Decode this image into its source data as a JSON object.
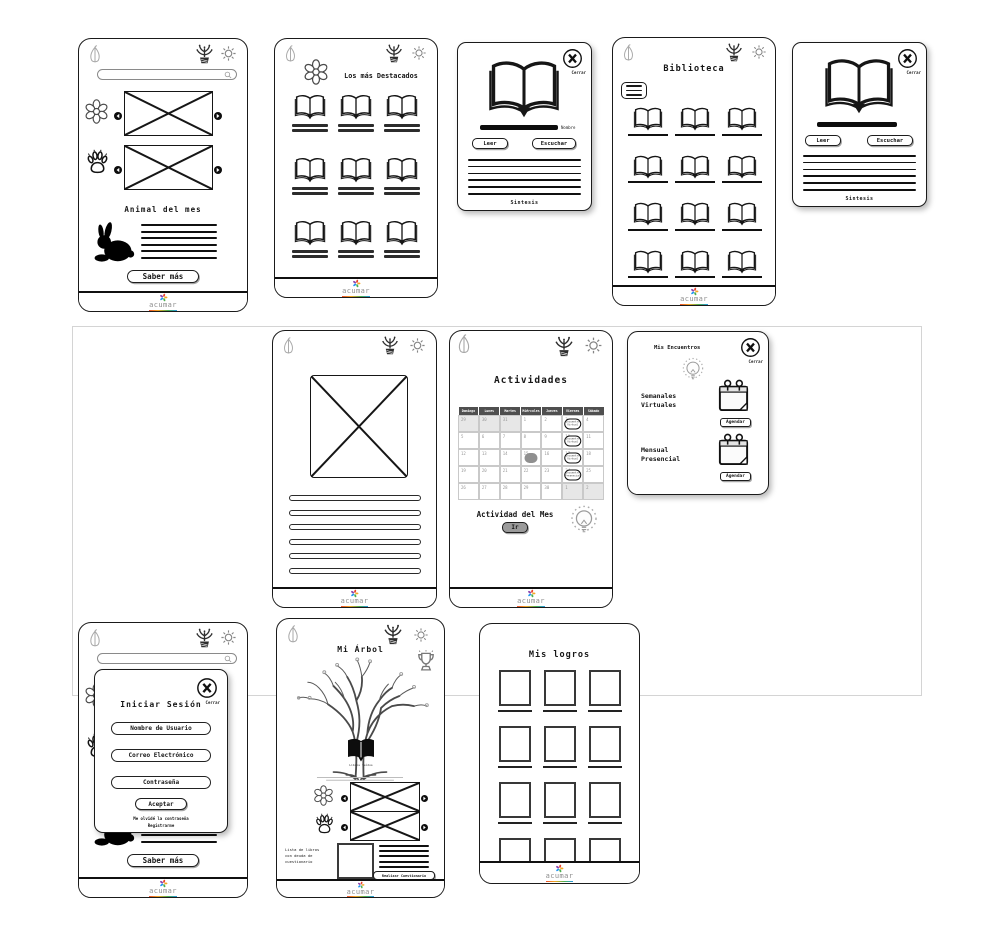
{
  "brand": {
    "name": "acumar"
  },
  "home": {
    "animal_title": "Animal del mes",
    "saber_mas": "Saber más"
  },
  "destacados": {
    "title": "Los más Destacados"
  },
  "book_detail": {
    "cerrar": "Cerrar",
    "nombre": "Nombre",
    "leer": "Leer",
    "escuchar": "Escuchar",
    "sintesis": "Sintesis"
  },
  "biblioteca": {
    "title": "Biblioteca"
  },
  "actividades": {
    "title": "Actividades",
    "actividad_mes": "Actividad del Mes",
    "ir": "Ir",
    "calendar": {
      "day_headers": [
        "Domingo",
        "Lunes",
        "Martes",
        "Miércoles",
        "Jueves",
        "Viernes",
        "Sábado"
      ],
      "weeks": [
        [
          "29",
          "30",
          "31",
          "1",
          "2",
          "3",
          "4"
        ],
        [
          "5",
          "6",
          "7",
          "8",
          "9",
          "10",
          "11"
        ],
        [
          "12",
          "13",
          "14",
          "15",
          "16",
          "17",
          "18"
        ],
        [
          "19",
          "20",
          "21",
          "22",
          "23",
          "24",
          "25"
        ],
        [
          "26",
          "27",
          "28",
          "29",
          "30",
          "1",
          "2"
        ]
      ],
      "muted": [
        [
          0,
          0
        ],
        [
          0,
          1
        ],
        [
          0,
          2
        ],
        [
          4,
          5
        ],
        [
          4,
          6
        ]
      ],
      "selected": {
        "week": 2,
        "col": 3
      },
      "events": [
        {
          "week": 0,
          "col": 5,
          "label": "Encuentro Virtual"
        },
        {
          "week": 1,
          "col": 5,
          "label": "Encuentro Virtual"
        },
        {
          "week": 2,
          "col": 5,
          "label": "Encuentro Virtual"
        },
        {
          "week": 3,
          "col": 5,
          "label": "Encuentro Presencial"
        }
      ]
    }
  },
  "encuentros": {
    "title": "Mis Encuentros",
    "cerrar": "Cerrar",
    "weekly": "Semanales\nVirtuales",
    "monthly": "Mensual\nPresencial",
    "agendar": "Agendar"
  },
  "login": {
    "title": "Iniciar Sesión",
    "cerrar": "Cerrar",
    "username": "Nombre de Usuario",
    "email": "Correo Electrónico",
    "password": "Contraseña",
    "aceptar": "Aceptar",
    "forgot": "Me olvidé la contraseña",
    "register": "Registrarme"
  },
  "arbol": {
    "title": "Mi Árbol",
    "book_caption": "Libros leídos",
    "lista_libros": "Lista de libros\ncon deuda de\ncuestionario",
    "realizar": "Realizar Cuestionario"
  },
  "logros": {
    "title": "Mis logros"
  }
}
